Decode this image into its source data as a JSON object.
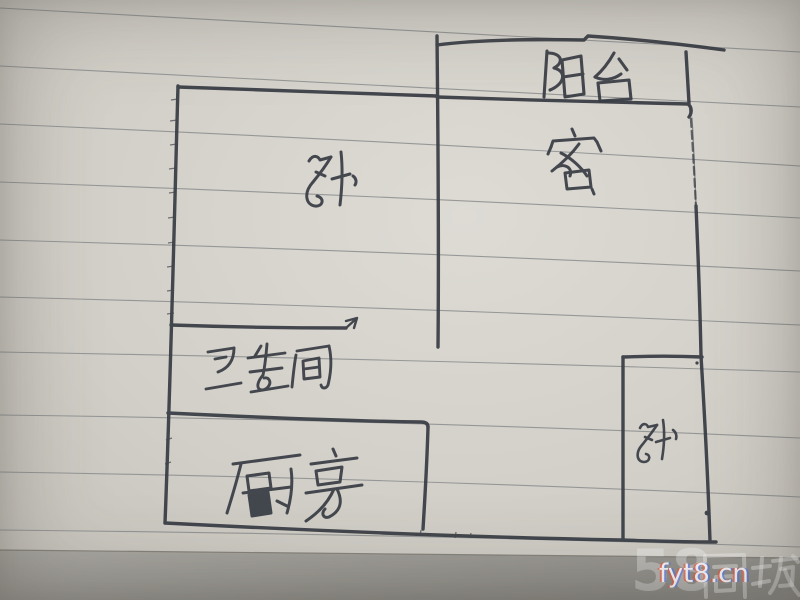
{
  "photo": {
    "description": "Hand-drawn apartment floor plan sketched in ink on lined notebook paper",
    "paper_color": "#d5d2cb",
    "ruled_line_color": "#8b8d8e",
    "ink_color": "#383c44"
  },
  "floorplan": {
    "rooms": [
      {
        "id": "balcony",
        "label": "阳台",
        "position": "top-right"
      },
      {
        "id": "living-room",
        "label": "客",
        "position": "upper-right"
      },
      {
        "id": "bedroom-main",
        "label": "卧",
        "position": "upper-left"
      },
      {
        "id": "bathroom",
        "label": "卫生间",
        "position": "middle-left"
      },
      {
        "id": "kitchen",
        "label": "厨房",
        "position": "bottom-left"
      },
      {
        "id": "bedroom-small",
        "label": "卧",
        "position": "bottom-right"
      }
    ]
  },
  "watermark": {
    "site_text": "fyt8.cn",
    "brand_prefix": "58",
    "brand_suffix": "同城",
    "color": "#ffffff"
  }
}
